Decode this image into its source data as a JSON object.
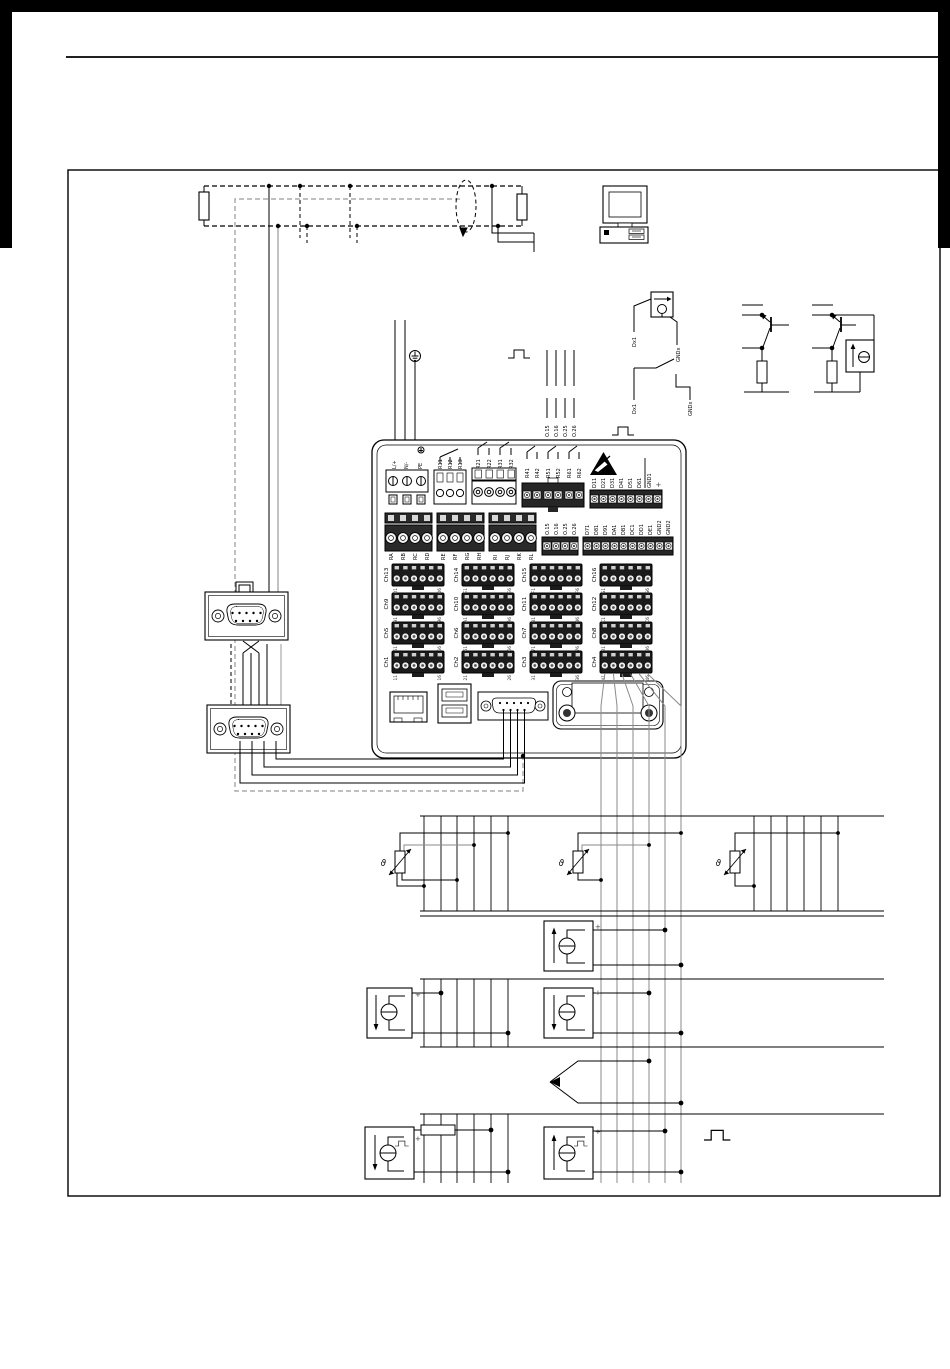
{
  "device": {
    "power_terminals": [
      "L/+",
      "N/-",
      "PE"
    ],
    "relay_terminals": [
      "R11",
      "R12",
      "R13",
      "R21",
      "R22",
      "R31",
      "R32",
      "R41",
      "R42",
      "R51",
      "R52",
      "R61",
      "R62"
    ],
    "digital_inputs_1": [
      "D11",
      "D21",
      "D31",
      "D41",
      "D51",
      "D61",
      "GND1"
    ],
    "digital_plus": "+",
    "relay_extension_terminals": [
      "RA",
      "RB",
      "RC",
      "RD",
      "RE",
      "RF",
      "RG",
      "RH",
      "RI",
      "RJ",
      "RK",
      "RL"
    ],
    "open_collector_outputs": [
      "O.15",
      "O.16",
      "O.25",
      "O.26"
    ],
    "digital_inputs_2": [
      "D71",
      "D81",
      "D91",
      "DA1",
      "DB1",
      "DC1",
      "DD1",
      "DE1",
      "GND2",
      "GND2"
    ],
    "channels": [
      {
        "label": "Ch13",
        "first": "D1",
        "last": "D6"
      },
      {
        "label": "Ch14",
        "first": "E1",
        "last": "E6"
      },
      {
        "label": "Ch15",
        "first": "F1",
        "last": "F6"
      },
      {
        "label": "Ch16",
        "first": "G1",
        "last": "G6"
      },
      {
        "label": "Ch9",
        "first": "91",
        "last": "96"
      },
      {
        "label": "Ch10",
        "first": "A1",
        "last": "A6"
      },
      {
        "label": "Ch11",
        "first": "B1",
        "last": "B6"
      },
      {
        "label": "Ch12",
        "first": "C1",
        "last": "C6"
      },
      {
        "label": "Ch5",
        "first": "51",
        "last": "56"
      },
      {
        "label": "Ch6",
        "first": "61",
        "last": "66"
      },
      {
        "label": "Ch7",
        "first": "71",
        "last": "76"
      },
      {
        "label": "Ch8",
        "first": "81",
        "last": "86"
      },
      {
        "label": "Ch1",
        "first": "11",
        "last": "16"
      },
      {
        "label": "Ch2",
        "first": "21",
        "last": "26"
      },
      {
        "label": "Ch3",
        "first": "31",
        "last": "36"
      },
      {
        "label": "Ch4",
        "first": "41",
        "last": "46"
      }
    ]
  },
  "examples": {
    "digital_line_label": "Dx1",
    "digital_ground_label": "GNDx",
    "temp_symbol": "ϑ",
    "plus": "+"
  },
  "colors": {
    "shield_wire": "#9a9a9a",
    "signal_wire": "#000000"
  }
}
